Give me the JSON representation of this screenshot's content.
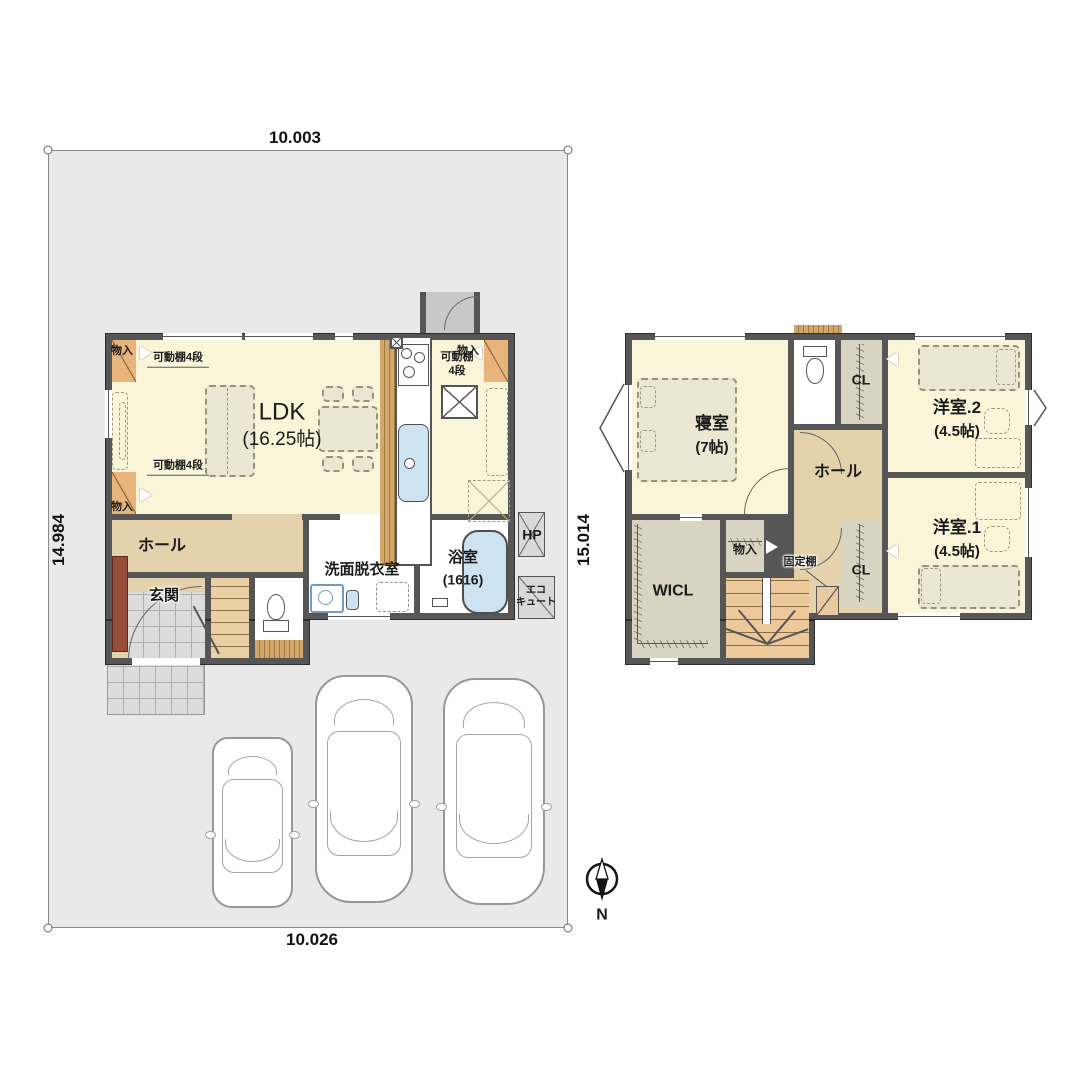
{
  "site": {
    "dim_top": "10.003",
    "dim_bottom": "10.026",
    "dim_left": "14.984",
    "dim_right": "15.014"
  },
  "floor1": {
    "ldk": "LDK",
    "ldk_size": "(16.25帖)",
    "hall": "ホール",
    "entrance": "玄関",
    "washroom": "洗面脱衣室",
    "bath": "浴室",
    "bath_size": "(1616)",
    "storage": "物入",
    "shelf4": "可動棚4段",
    "shelf4_line1": "可動棚",
    "shelf4_line2": "4段",
    "hp": "HP",
    "ecocute_line1": "エコ",
    "ecocute_line2": "キュート"
  },
  "floor2": {
    "bedroom": "寝室",
    "bedroom_size": "(7帖)",
    "western2": "洋室.2",
    "western2_size": "(4.5帖)",
    "western1": "洋室.1",
    "western1_size": "(4.5帖)",
    "hall": "ホール",
    "wicl": "WICL",
    "cl": "CL",
    "storage": "物入",
    "fixed_shelf": "固定棚"
  },
  "compass": {
    "north_label": "N"
  },
  "colors": {
    "wall": "#565656",
    "floor_cream": "#faf5d8",
    "floor_tan": "#e4d2ac",
    "closet_orange": "#e9b47c",
    "closet_gray": "#d9d3c1",
    "water_blue": "#cde3f2",
    "site_gray": "#e9e9e9",
    "wood": "#d2a76c",
    "cabinet_brown": "#984c39"
  }
}
